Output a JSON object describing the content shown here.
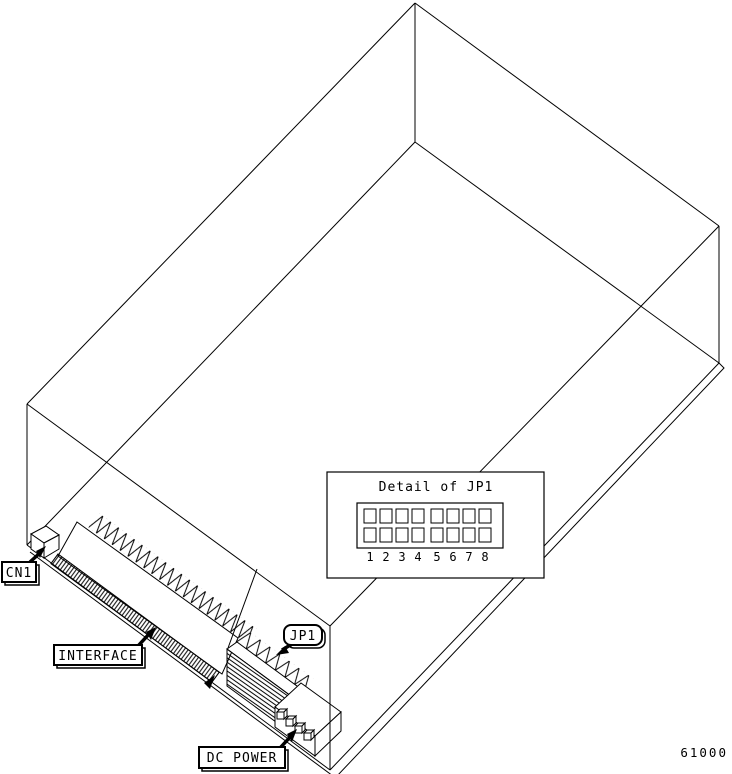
{
  "diagram": {
    "part_number": "61000",
    "labels": {
      "cn1": "CN1",
      "interface": "INTERFACE",
      "jp1": "JP1",
      "dc_power": "DC POWER"
    },
    "detail_inset": {
      "title": "Detail of JP1",
      "rows": 2,
      "columns": 8,
      "pin_numbers": [
        "1",
        "2",
        "3",
        "4",
        "5",
        "6",
        "7",
        "8"
      ]
    },
    "colors": {
      "line": "#000000",
      "background": "#ffffff"
    }
  }
}
